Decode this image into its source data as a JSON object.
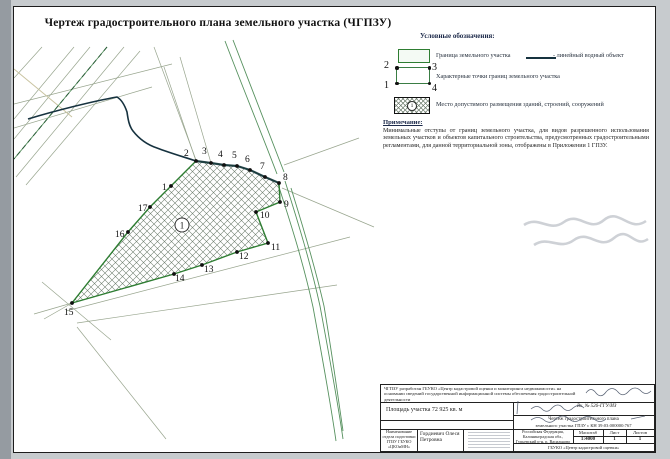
{
  "document": {
    "title": "Чертеж градостроительного плана земельного участка (ЧГПЗУ)"
  },
  "legend": {
    "title": "Условные обозначения:",
    "boundary_label": "Граница земельного участка",
    "water_label": "- линейный водный объект",
    "points_label": "Характерные точки границ земельного участка",
    "placement_label": "Место допустимого размещения зданий, строений, сооружений",
    "corners": {
      "tl": "2",
      "tr": "3",
      "bl": "1",
      "br": "4"
    },
    "swatch_zone_number": "1",
    "note_title": "Примечание:",
    "note_text": "Минимальные отступы от границ земельного участка, для видов разрешенного использования земельных участков и объектов капитального строительства, предусмотренных градостроительными регламентами, для данной территориальной зоны, отображены в Приложении 1 ГПЗУ."
  },
  "map": {
    "zone_number": "1",
    "colors": {
      "boundary": "#2e7d32",
      "water": "#16323f",
      "roads": "#57915f",
      "cadastral": "#98a58e"
    },
    "parcel": {
      "vertices": [
        {
          "n": "1",
          "x": 157,
          "y": 179,
          "lx": 148,
          "ly": 183
        },
        {
          "n": "2",
          "x": 182,
          "y": 154,
          "lx": 170,
          "ly": 149
        },
        {
          "n": "3",
          "x": 197,
          "y": 156,
          "lx": 188,
          "ly": 147
        },
        {
          "n": "4",
          "x": 210,
          "y": 158,
          "lx": 204,
          "ly": 150
        },
        {
          "n": "5",
          "x": 223,
          "y": 159,
          "lx": 218,
          "ly": 151
        },
        {
          "n": "6",
          "x": 236,
          "y": 163,
          "lx": 231,
          "ly": 155
        },
        {
          "n": "7",
          "x": 251,
          "y": 170,
          "lx": 246,
          "ly": 162
        },
        {
          "n": "8",
          "x": 265,
          "y": 176,
          "lx": 269,
          "ly": 173
        },
        {
          "n": "9",
          "x": 266,
          "y": 195,
          "lx": 270,
          "ly": 200
        },
        {
          "n": "10",
          "x": 242,
          "y": 205,
          "lx": 246,
          "ly": 211
        },
        {
          "n": "11",
          "x": 254,
          "y": 236,
          "lx": 257,
          "ly": 243
        },
        {
          "n": "12",
          "x": 223,
          "y": 245,
          "lx": 225,
          "ly": 252
        },
        {
          "n": "13",
          "x": 188,
          "y": 258,
          "lx": 190,
          "ly": 265
        },
        {
          "n": "14",
          "x": 160,
          "y": 267,
          "lx": 161,
          "ly": 274
        },
        {
          "n": "15",
          "x": 58,
          "y": 296,
          "lx": 50,
          "ly": 308
        },
        {
          "n": "16",
          "x": 114,
          "y": 225,
          "lx": 101,
          "ly": 230
        },
        {
          "n": "17",
          "x": 136,
          "y": 200,
          "lx": 124,
          "ly": 204
        }
      ]
    }
  },
  "stamp": {
    "developer_text": "ЧГПЗУ разработан ГБУКО «Центр кадастровой оценки и мониторинга недвижимости» на основании сведений государственной информационной системы обеспечения градостроительной деятельности",
    "inbox_number": "Вх. № 526-ГГУ/ИЗ",
    "area_text": "Площадь участка 72 925 кв. м",
    "drawing_title_line1": "Чертеж градостроительного плана",
    "drawing_title_line2": "земельного участка ГПЗУ с КН 39:03:000000:767",
    "department": "Наименование отдела подготовки ГПЗУ ГБУКО «ЦКОиМН»",
    "author": "Гордиевич Олеся Петровна",
    "location": "Российская Федерация, Калининградская обл., Гурьевский р-н, п. Васильково",
    "scale_label": "Масштаб",
    "scale_value": "1:4000",
    "sheet_label": "Лист",
    "sheet_value": "1",
    "sheets_label": "Листов",
    "sheets_value": "1",
    "organization": "ГБУКО «Центр кадастровой оценки»"
  }
}
